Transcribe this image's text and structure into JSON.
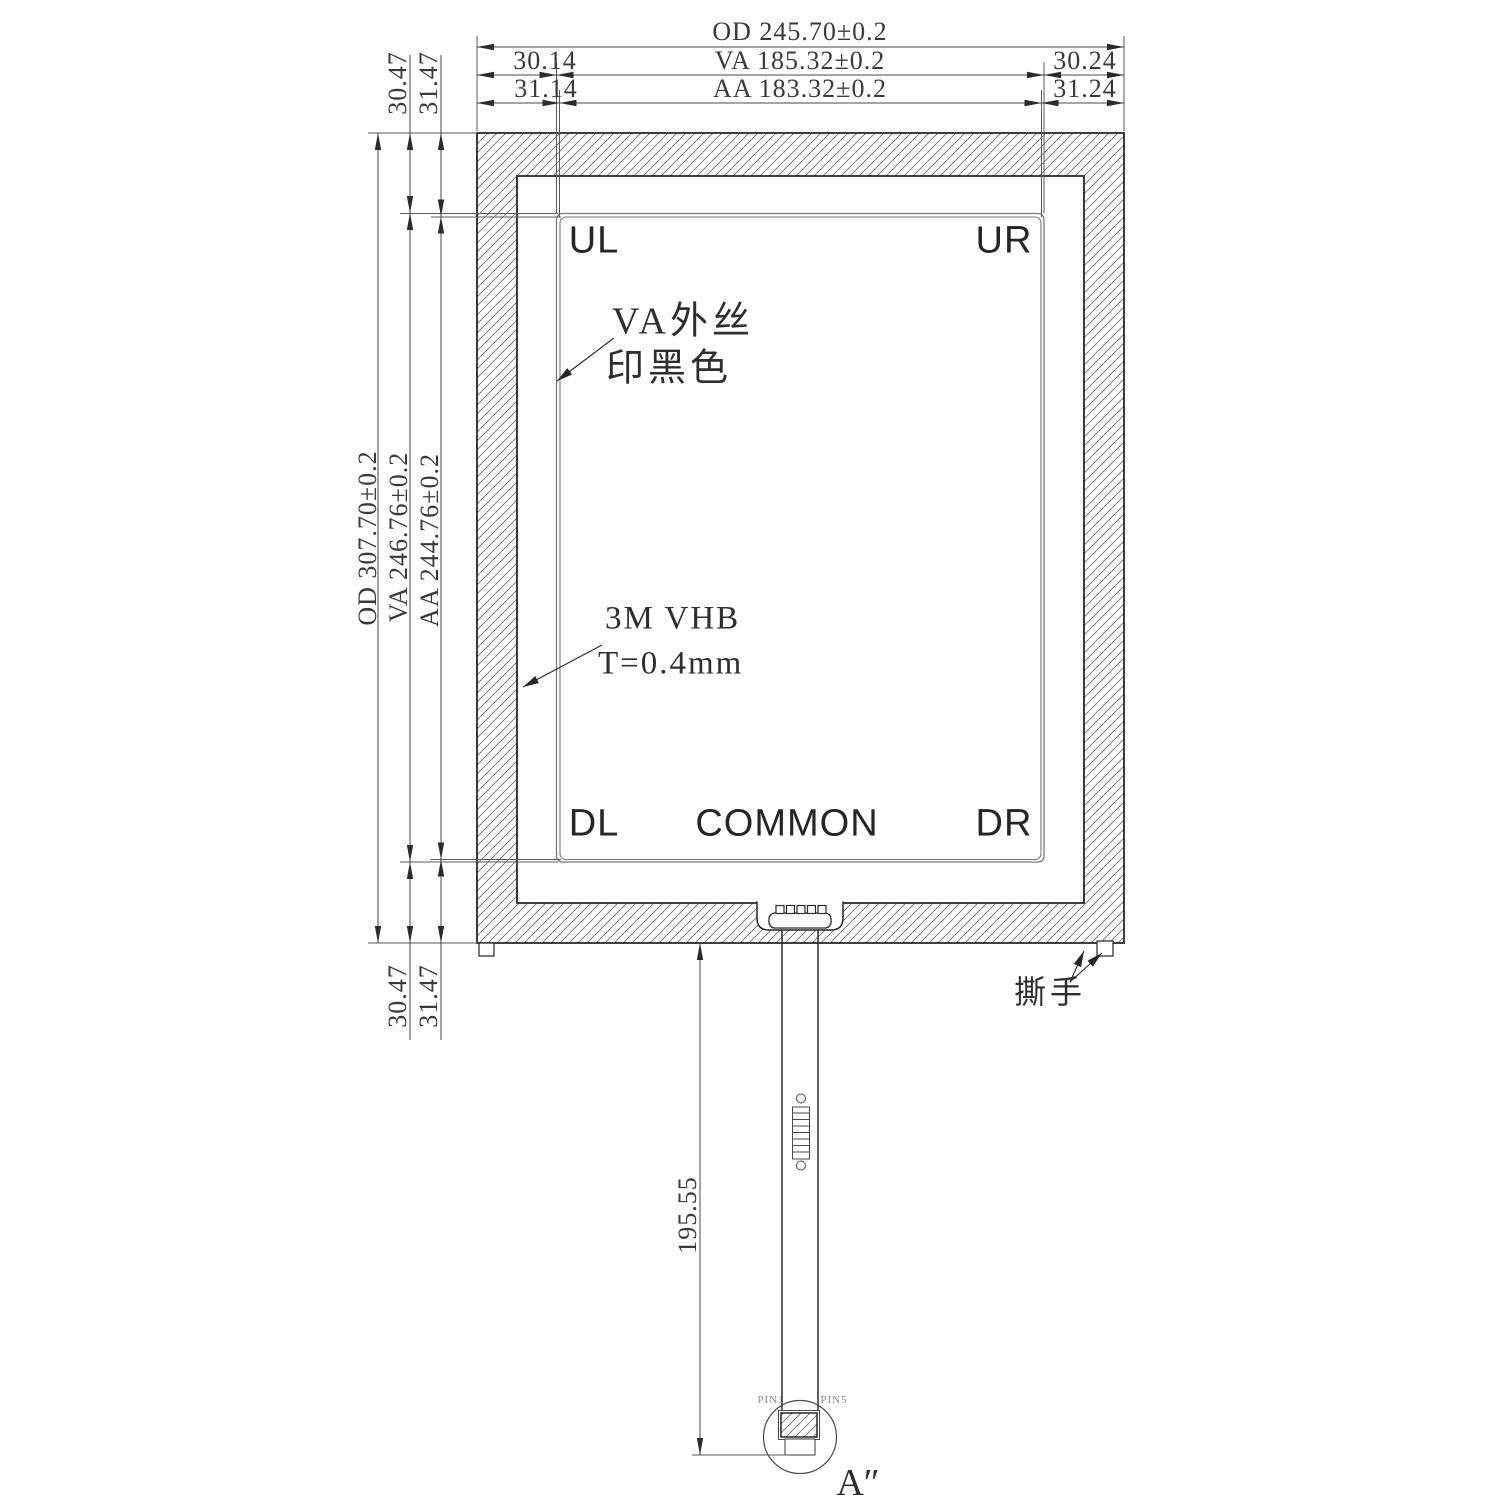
{
  "drawing": {
    "top_dimensions": {
      "od": "OD 245.70±0.2",
      "va_left_offset": "30.14",
      "va": "VA 185.32±0.2",
      "va_right_offset": "30.24",
      "aa_left_offset": "31.14",
      "aa": "AA 183.32±0.2",
      "aa_right_offset": "31.24"
    },
    "left_dimensions": {
      "od": "OD 307.70±0.2",
      "va": "VA 246.76±0.2",
      "aa": "AA 244.76±0.2",
      "va_top_offset": "30.47",
      "aa_top_offset": "31.47",
      "va_bottom_offset": "30.47",
      "aa_bottom_offset": "31.47"
    },
    "panel_labels": {
      "upper_left": "UL",
      "upper_right": "UR",
      "down_left": "DL",
      "down_right": "DR",
      "common": "COMMON"
    },
    "annotations": {
      "va_silk_line1": "VA外丝",
      "va_silk_line2": "印黑色",
      "vhb_line1": "3M VHB",
      "vhb_line2": "T=0.4mm",
      "tear_tab": "撕手",
      "tail_length": "195.55",
      "pin1": "PIN1",
      "pin5": "PIN5",
      "detail_label": "A″"
    },
    "colors": {
      "background": "#ffffff",
      "outline": "#262626",
      "dimension": "#4a4a4a",
      "hatch": "#6d6d6d",
      "text": "#3a3a3a"
    }
  }
}
